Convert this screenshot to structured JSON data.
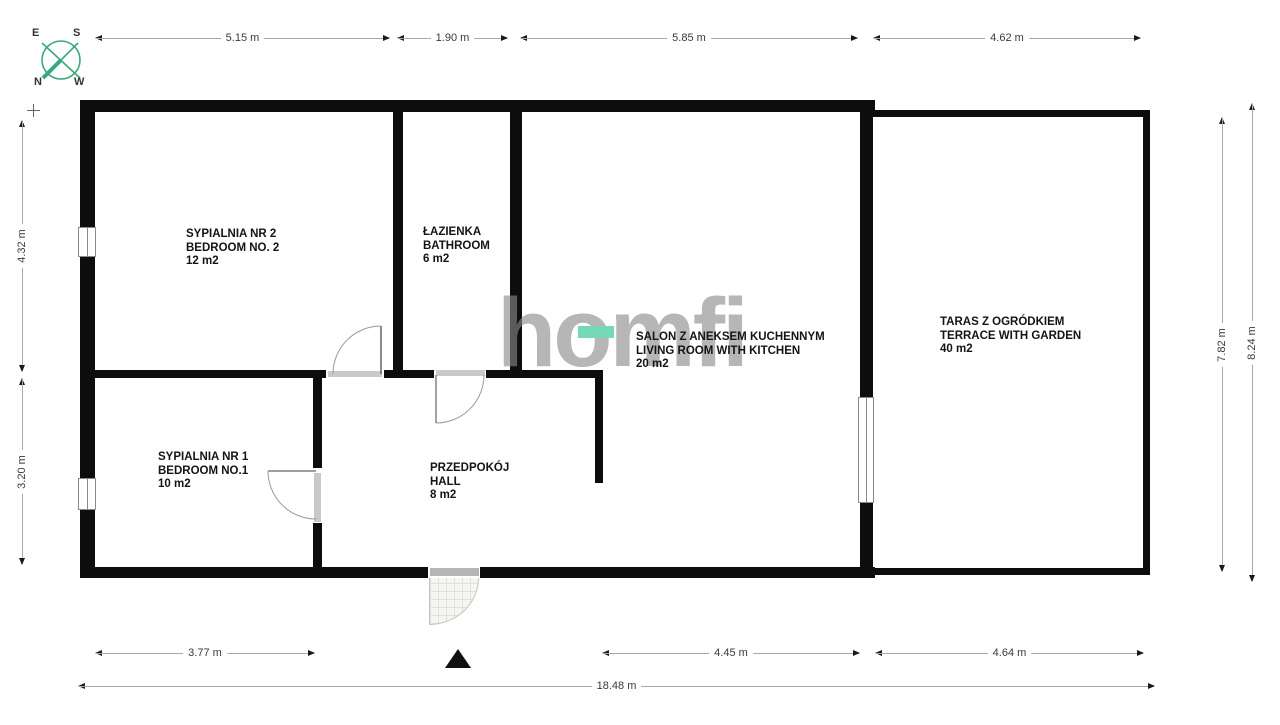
{
  "compass": {
    "e": "E",
    "s": "S",
    "n": "N",
    "w": "W"
  },
  "watermark": {
    "text": "homfi",
    "text_color": "#8b8b8b",
    "accent_color": "#74d9b4"
  },
  "rooms": [
    {
      "name_pl": "SYPIALNIA NR 2",
      "name_en": "BEDROOM NO. 2",
      "area": "12 m2"
    },
    {
      "name_pl": "ŁAZIENKA",
      "name_en": "BATHROOM",
      "area": "6 m2"
    },
    {
      "name_pl": "SALON Z ANEKSEM KUCHENNYM",
      "name_en": "LIVING ROOM WITH KITCHEN",
      "area": "20 m2"
    },
    {
      "name_pl": "TARAS Z OGRÓDKIEM",
      "name_en": "TERRACE WITH GARDEN",
      "area": "40 m2"
    },
    {
      "name_pl": "SYPIALNIA NR 1",
      "name_en": "BEDROOM NO.1",
      "area": "10 m2"
    },
    {
      "name_pl": "PRZEDPOKÓJ",
      "name_en": "HALL",
      "area": "8 m2"
    }
  ],
  "dimensions": {
    "top": [
      "5.15 m",
      "1.90 m",
      "5.85 m",
      "4.62 m"
    ],
    "left": [
      "4.32 m",
      "3.20 m"
    ],
    "right": [
      "7.82 m",
      "8.24 m"
    ],
    "bottom": [
      "3.77 m",
      "4.45 m",
      "4.64 m"
    ],
    "total": "18.48 m"
  },
  "colors": {
    "wall": "#0d0d0d",
    "compass_green": "#3aa87c"
  }
}
